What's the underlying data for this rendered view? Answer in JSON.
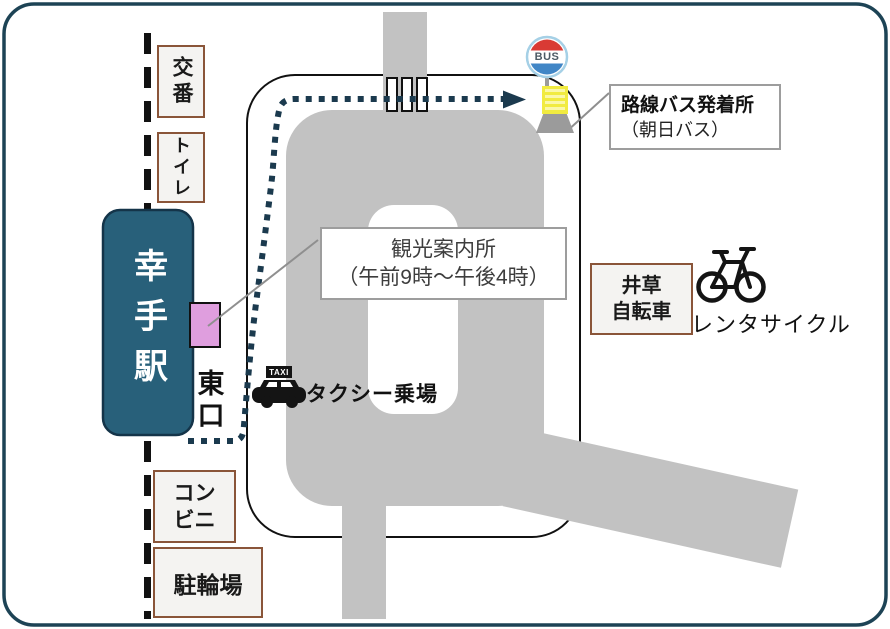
{
  "station": {
    "name": "幸手駅",
    "exit": "東口"
  },
  "facilities": {
    "koban": "交番",
    "toilet": "トイレ",
    "conbini_line1": "コン",
    "conbini_line2": "ビニ",
    "bicycle_parking": "駐輪場",
    "igusa_line1": "井草",
    "igusa_line2": "自転車",
    "rental_cycle": "レンタサイクル",
    "taxi_stand": "タクシー乗場",
    "tourist_info_line1": "観光案内所",
    "tourist_info_line2": "（午前9時～午後4時）",
    "bus_terminal_line1": "路線バス発着所",
    "bus_terminal_line2": "（朝日バス）"
  },
  "icons": {
    "bus_sign": "BUS",
    "taxi_sign": "TAXI"
  },
  "colors": {
    "road": "#c2c2c2",
    "station_fill": "#28607a",
    "frame": "#1d4355",
    "facility_border": "#8a5539",
    "route_dots": "#1b3a4e",
    "info_marker_pink": "#df9ede",
    "bus_sign_red": "#d93a34",
    "bus_sign_blue": "#4186c6",
    "timetable_yellow": "#f1eb40"
  }
}
